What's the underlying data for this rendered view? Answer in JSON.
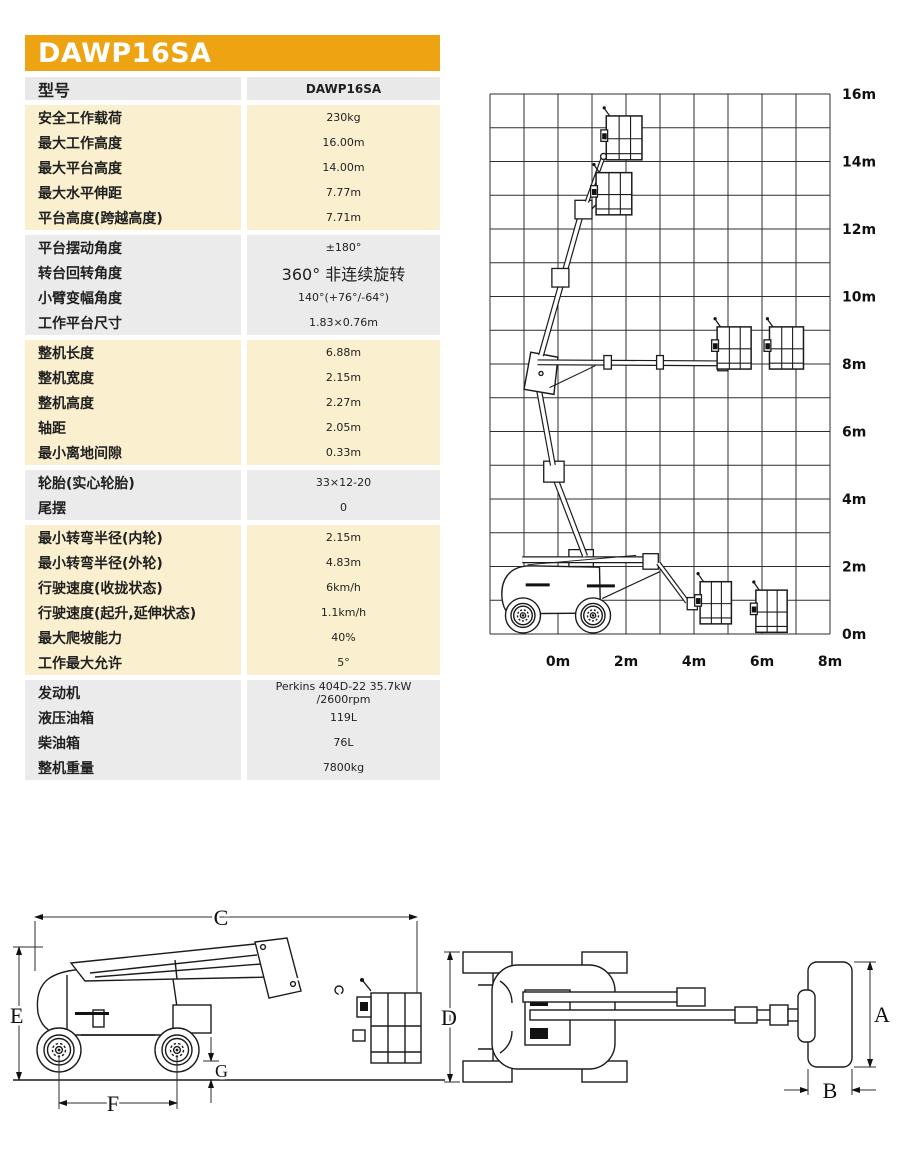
{
  "header": {
    "model": "DAWP16SA",
    "band_color": "#EEA412"
  },
  "spec_table": {
    "header_row": {
      "label": "型号",
      "value": "DAWP16SA"
    },
    "groups": [
      {
        "tone": "cream",
        "rows": [
          {
            "label": "安全工作载荷",
            "value": "230kg"
          },
          {
            "label": "最大工作高度",
            "value": "16.00m"
          },
          {
            "label": "最大平台高度",
            "value": "14.00m"
          },
          {
            "label": "最大水平伸距",
            "value": "7.77m"
          },
          {
            "label": "平台高度(跨越高度)",
            "value": "7.71m"
          }
        ]
      },
      {
        "tone": "gray",
        "rows": [
          {
            "label": "平台摆动角度",
            "value": "±180°"
          },
          {
            "label": "转台回转角度",
            "value": "360° 非连续旋转",
            "big": true
          },
          {
            "label": "小臂变幅角度",
            "value": "140°(+76°/-64°)"
          },
          {
            "label": "工作平台尺寸",
            "value": "1.83×0.76m"
          }
        ]
      },
      {
        "tone": "cream",
        "rows": [
          {
            "label": "整机长度",
            "value": "6.88m"
          },
          {
            "label": "整机宽度",
            "value": "2.15m"
          },
          {
            "label": "整机高度",
            "value": "2.27m"
          },
          {
            "label": "轴距",
            "value": "2.05m"
          },
          {
            "label": "最小离地间隙",
            "value": "0.33m"
          }
        ]
      },
      {
        "tone": "gray",
        "rows": [
          {
            "label": "轮胎(实心轮胎)",
            "value": "33×12-20"
          },
          {
            "label": "尾摆",
            "value": "0"
          }
        ]
      },
      {
        "tone": "cream",
        "rows": [
          {
            "label": "最小转弯半径(内轮)",
            "value": "2.15m"
          },
          {
            "label": "最小转弯半径(外轮)",
            "value": "4.83m"
          },
          {
            "label": "行驶速度(收拢状态)",
            "value": "6km/h"
          },
          {
            "label": "行驶速度(起升,延伸状态)",
            "value": "1.1km/h"
          },
          {
            "label": "最大爬坡能力",
            "value": "40%"
          },
          {
            "label": "工作最大允许",
            "value": "5°"
          }
        ]
      },
      {
        "tone": "gray",
        "rows": [
          {
            "label": "发动机",
            "value": "Perkins 404D-22 35.7kW /2600rpm"
          },
          {
            "label": "液压油箱",
            "value": "119L"
          },
          {
            "label": "柴油箱",
            "value": "76L"
          },
          {
            "label": "整机重量",
            "value": "7800kg"
          }
        ]
      }
    ]
  },
  "chart_data": {
    "type": "working-envelope-diagram",
    "y_ticks": [
      "16m",
      "14m",
      "12m",
      "10m",
      "8m",
      "6m",
      "4m",
      "2m",
      "0m"
    ],
    "x_ticks": [
      "0m",
      "2m",
      "4m",
      "6m",
      "8m"
    ],
    "x_range_m": [
      -2,
      8
    ],
    "y_range_m": [
      0,
      16
    ],
    "grid_step_m": 1,
    "platform_positions_m": [
      {
        "x": 1.9,
        "y": 14.7
      },
      {
        "x": 1.6,
        "y": 13.0
      },
      {
        "x": 5.2,
        "y": 8.5
      },
      {
        "x": 6.7,
        "y": 8.5
      },
      {
        "x": 4.6,
        "y": 0.9
      },
      {
        "x": 6.3,
        "y": 0.6
      }
    ]
  },
  "dimension_drawings": {
    "side_view": {
      "labels": [
        "C",
        "E",
        "F",
        "G"
      ]
    },
    "top_view": {
      "labels": [
        "D",
        "A",
        "B"
      ]
    }
  }
}
